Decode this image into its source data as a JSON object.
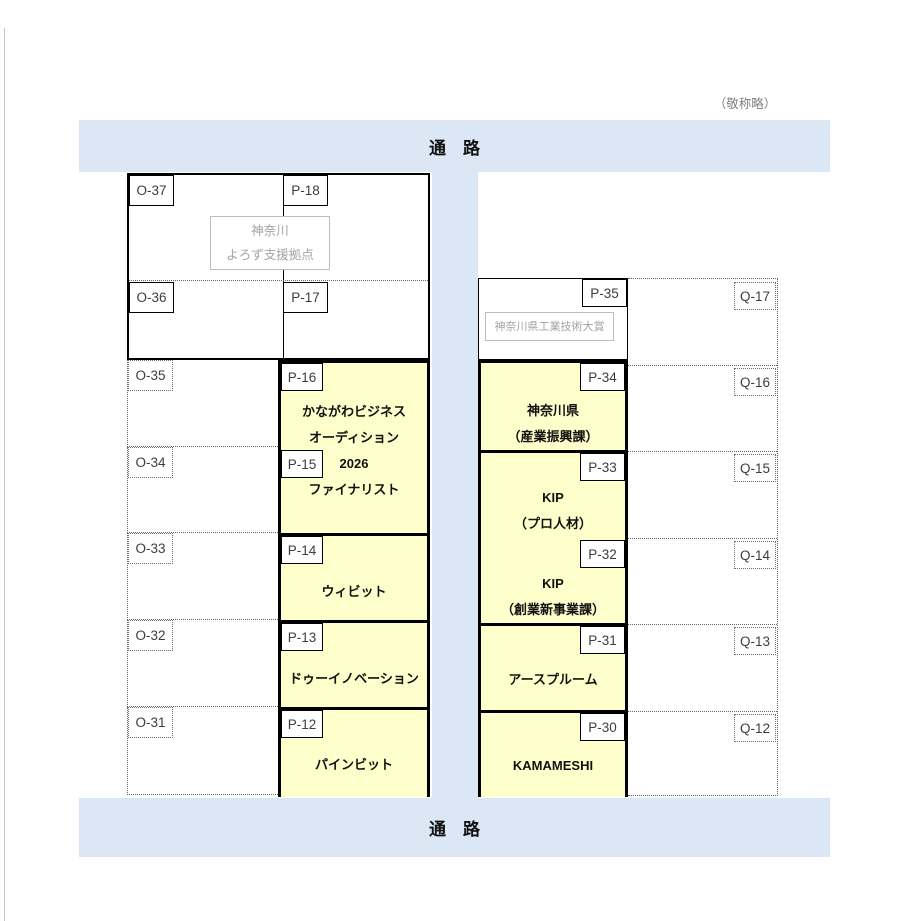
{
  "page": {
    "honorific_note": "（敬称略）"
  },
  "aisles": {
    "top_label": "通　路",
    "bottom_label": "通　路"
  },
  "left_block": {
    "cell_o37": "O-37",
    "cell_p18": "P-18",
    "cell_o36": "O-36",
    "cell_p17": "P-17",
    "support_box": {
      "line1": "神奈川",
      "line2": "よろず支援拠点"
    }
  },
  "o_column": {
    "o35": "O-35",
    "o34": "O-34",
    "o33": "O-33",
    "o32": "O-32",
    "o31": "O-31"
  },
  "p_left": {
    "label_p16": "P-16",
    "label_p15": "P-15",
    "label_p14": "P-14",
    "label_p13": "P-13",
    "label_p12": "P-12",
    "booth_p16_15": {
      "line1": "かながわビジネス",
      "line2": "オーディション",
      "line3": "2026",
      "line4": "ファイナリスト"
    },
    "booth_p14": "ウィビット",
    "booth_p13": "ドゥーイノベーション",
    "booth_p12": "パインビット"
  },
  "p_right": {
    "label_p35": "P-35",
    "label_p34": "P-34",
    "label_p33": "P-33",
    "label_p32": "P-32",
    "label_p31": "P-31",
    "label_p30": "P-30",
    "award_box": "神奈川県工業技術大賞",
    "booth_p34": {
      "line1": "神奈川県",
      "line2": "（産業振興課）"
    },
    "booth_p33": {
      "line1": "KIP",
      "line2": "（プロ人材）"
    },
    "booth_p32": {
      "line1": "KIP",
      "line2": "（創業新事業課）"
    },
    "booth_p31": "アースプルーム",
    "booth_p30": "KAMAMESHI"
  },
  "q_column": {
    "q17": "Q-17",
    "q16": "Q-16",
    "q15": "Q-15",
    "q14": "Q-14",
    "q13": "Q-13",
    "q12": "Q-12"
  },
  "colors": {
    "aisle_blue": "#dbe7f5",
    "booth_yellow": "#ffffcc"
  }
}
